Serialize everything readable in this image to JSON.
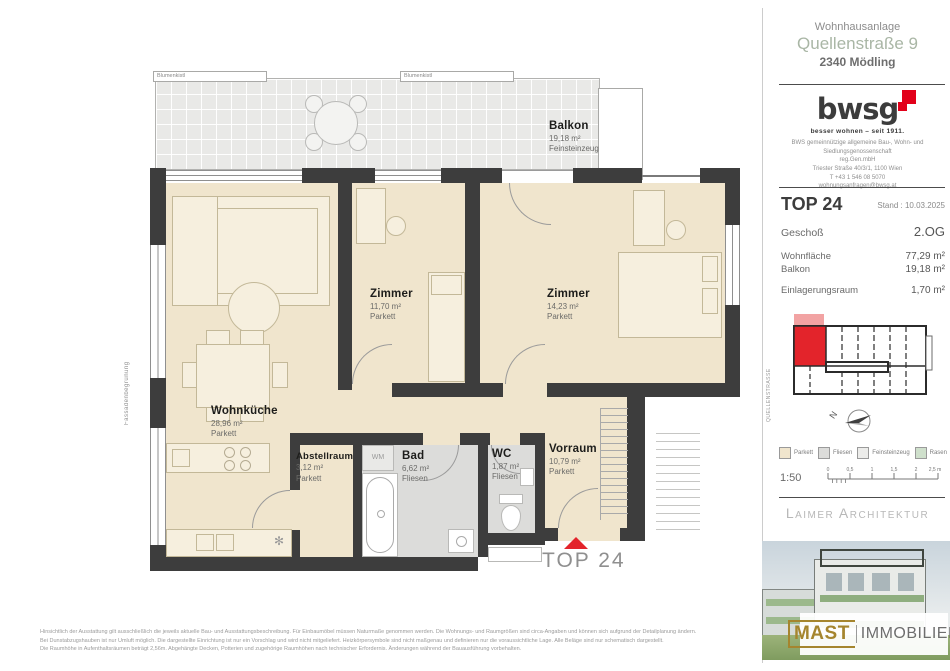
{
  "header": {
    "project": "Wohnhausanlage",
    "street": "Quellenstraße 9",
    "city": "2340 Mödling"
  },
  "bwsg": {
    "logo_text": "bwsg",
    "tagline": "besser wohnen – seit 1911.",
    "contact_lines": [
      "BWS gemeinnützige allgemeine Bau-, Wohn- und",
      "Siedlungsgenossenschaft",
      "reg.Gen.mbH",
      "Triester Straße 40/3/1, 1100 Wien",
      "T +43 1 546 08 5070",
      "wohnungsanfragen@bwsg.at"
    ]
  },
  "unit": {
    "top_label": "TOP 24",
    "stand": "Stand : 10.03.2025",
    "geschoss_label": "Geschoß",
    "geschoss_value": "2.OG",
    "rows": [
      {
        "label": "Wohnfläche",
        "value": "77,29 m²"
      },
      {
        "label": "Balkon",
        "value": "19,18 m²"
      },
      {
        "label": "Einlagerungsraum",
        "value": "1,70 m²"
      }
    ]
  },
  "siteplan": {
    "street_label": "QUELLENSTRASSE",
    "north_label": "N"
  },
  "legend": {
    "items": [
      {
        "label": "Parkett",
        "color": "#f0e5cd"
      },
      {
        "label": "Fliesen",
        "color": "#dcdcda"
      },
      {
        "label": "Feinsteinzeug",
        "color": "#ececea"
      },
      {
        "label": "Rasen",
        "color": "#cfe0cc"
      }
    ],
    "scale_label": "1:50",
    "ruler_ticks": [
      "0",
      "0,5",
      "1",
      "1,5",
      "2",
      "2,5 m"
    ]
  },
  "architect_label": "Laimer Architektur",
  "broker": {
    "name_primary": "MAST",
    "name_secondary": "IMMOBILIEN"
  },
  "plan": {
    "entry_label": "TOP 24",
    "rooms": [
      {
        "name": "Balkon",
        "area": "19,18 m²",
        "floor": "Feinsteinzeug"
      },
      {
        "name": "Zimmer",
        "area": "11,70 m²",
        "floor": "Parkett"
      },
      {
        "name": "Zimmer",
        "area": "14,23 m²",
        "floor": "Parkett"
      },
      {
        "name": "Wohnküche",
        "area": "28,96 m²",
        "floor": "Parkett"
      },
      {
        "name": "Abstellraum",
        "area": "3,12 m²",
        "floor": "Parkett"
      },
      {
        "name": "Bad",
        "area": "6,62 m²",
        "floor": "Fliesen"
      },
      {
        "name": "WC",
        "area": "1,87 m²",
        "floor": "Fliesen"
      },
      {
        "name": "Vorraum",
        "area": "10,79 m²",
        "floor": "Parkett"
      }
    ],
    "annotations": {
      "blumenkistl": "Blumenkistl",
      "pflanztrog": "Pflanztrog",
      "fassadenbegruenung": "Fassadenbegrünung",
      "wm": "WM"
    }
  },
  "disclaimer": {
    "lines": [
      "Hinsichtlich der Ausstattung gilt ausschließlich die jeweils aktuelle Bau- und Ausstattungsbeschreibung. Für Einbaumöbel müssen Naturmaße genommen werden. Die Wohnungs- und Raumgrößen sind circa-Angaben und können sich aufgrund der Detailplanung ändern.",
      "Bei Dunstabzugshauben ist nur Umluft möglich. Die dargestellte Einrichtung ist nur ein Vorschlag und wird nicht mitgeliefert. Heizkörpersymbole sind nicht maßgenau und definieren nur die voraussichtliche Lage. Alle Beläge sind nur schematisch dargestellt.",
      "Die Raumhöhe in Aufenthaltsräumen beträgt 2,56m. Abgehängte Decken, Potterien und zugehörige Raumhöhen nach technischer Erfordernis. Änderungen während der Bauausführung vorbehalten."
    ]
  },
  "colors": {
    "unit_red": "#e3242b",
    "bwsg_red": "#e2001a",
    "street_green": "#a9b6a5",
    "wall": "#3d3d3d",
    "parkett": "#f0e5cd",
    "fliesen": "#dcdcda",
    "feinsteinzeug": "#ececea",
    "rasen": "#cfe0cc",
    "mast_gold": "#a5852e"
  }
}
